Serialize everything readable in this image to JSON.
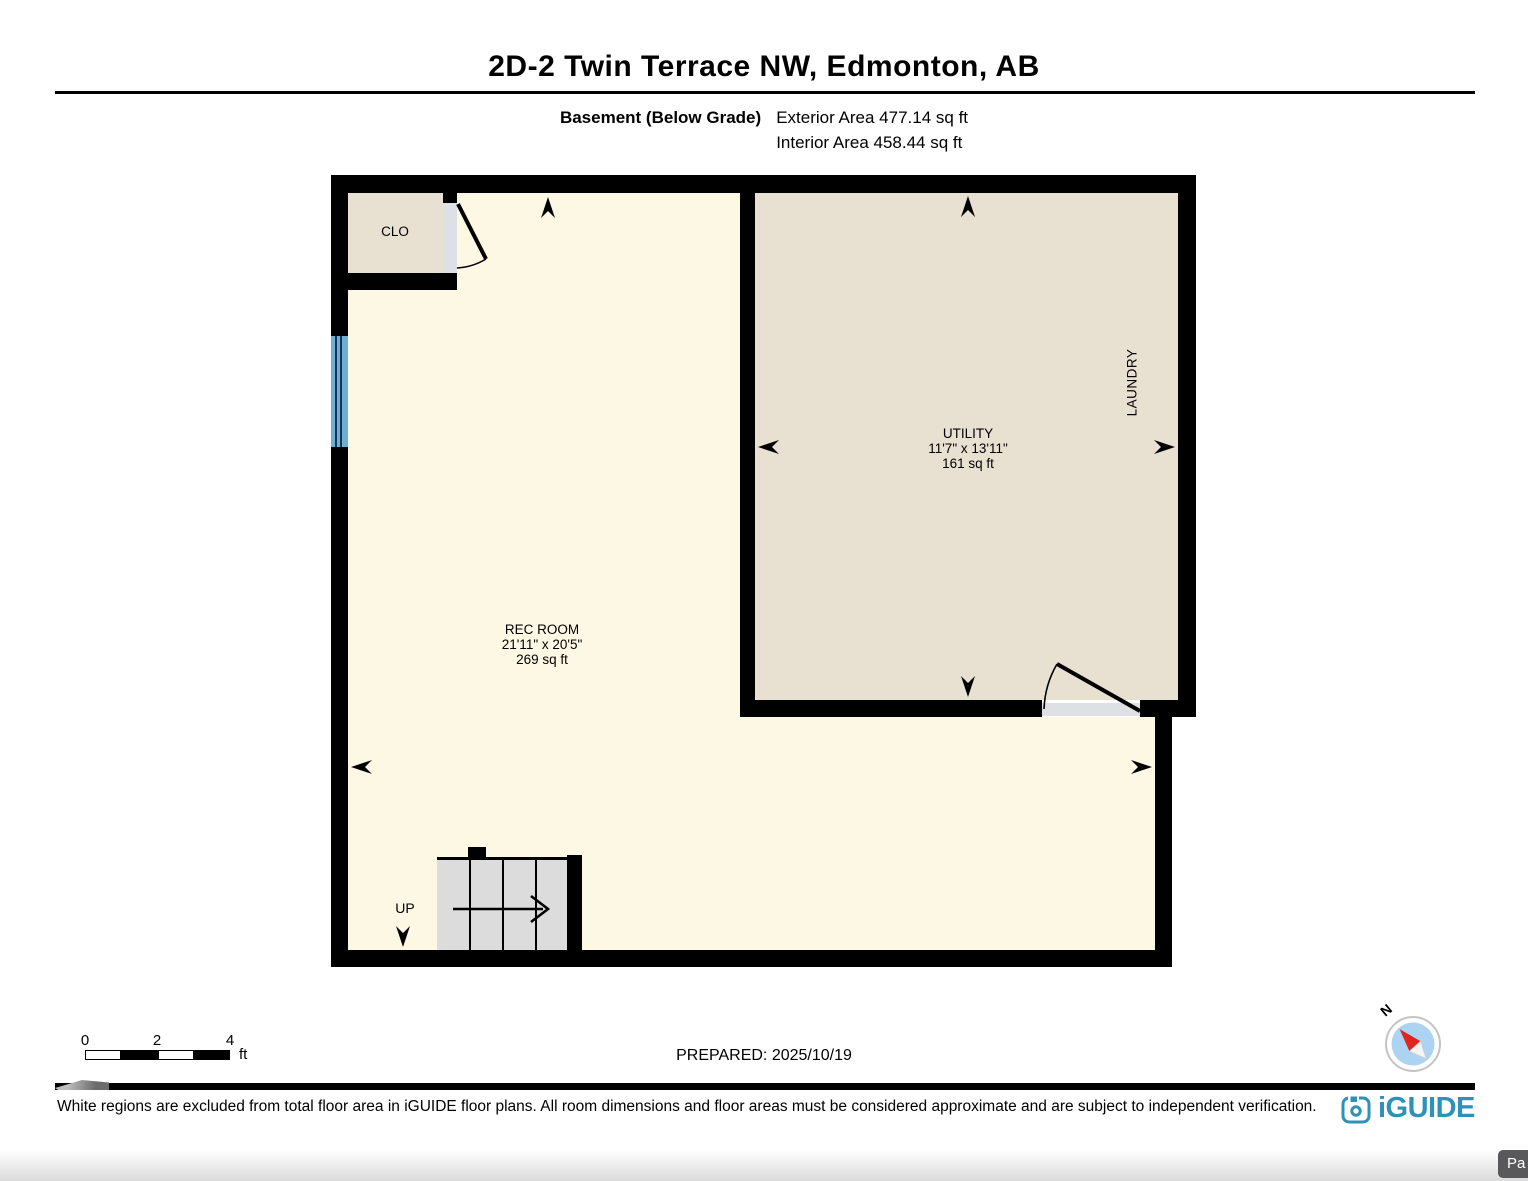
{
  "header": {
    "title": "2D-2 Twin Terrace NW, Edmonton, AB",
    "floor_label": "Basement (Below Grade)",
    "exterior_area": "Exterior Area 477.14 sq ft",
    "interior_area": "Interior Area 458.44 sq ft"
  },
  "plan": {
    "rooms": {
      "clo": {
        "name": "CLO"
      },
      "utility": {
        "name": "UTILITY",
        "dimensions": "11'7\" x 13'11\"",
        "area": "161 sq ft"
      },
      "laundry": {
        "name": "LAUNDRY"
      },
      "rec_room": {
        "name": "REC ROOM",
        "dimensions": "21'11\" x 20'5\"",
        "area": "269 sq ft"
      },
      "stairs": {
        "direction_label": "UP"
      }
    }
  },
  "scale_bar": {
    "tick_0": "0",
    "tick_2": "2",
    "tick_4": "4",
    "unit": "ft"
  },
  "prepared_label": "PREPARED: 2025/10/19",
  "compass": {
    "north_label": "N"
  },
  "footer": {
    "disclaimer": "White regions are excluded from total floor area in iGUIDE floor plans. All room dimensions and floor areas must be considered approximate and are subject to independent verification.",
    "brand": "iGUIDE"
  },
  "overlay_button": {
    "label": "Pa"
  },
  "colors": {
    "wall": "#000000",
    "rec_room_floor": "#fdf8e4",
    "utility_floor": "#e8e0d1",
    "stairs": "#dcdcdc",
    "threshold": "#dde1e6",
    "window": "#6fb0d2",
    "brand_blue": "#2f90b8",
    "compass_needle": "#e02420",
    "compass_face": "#aad4f2"
  }
}
